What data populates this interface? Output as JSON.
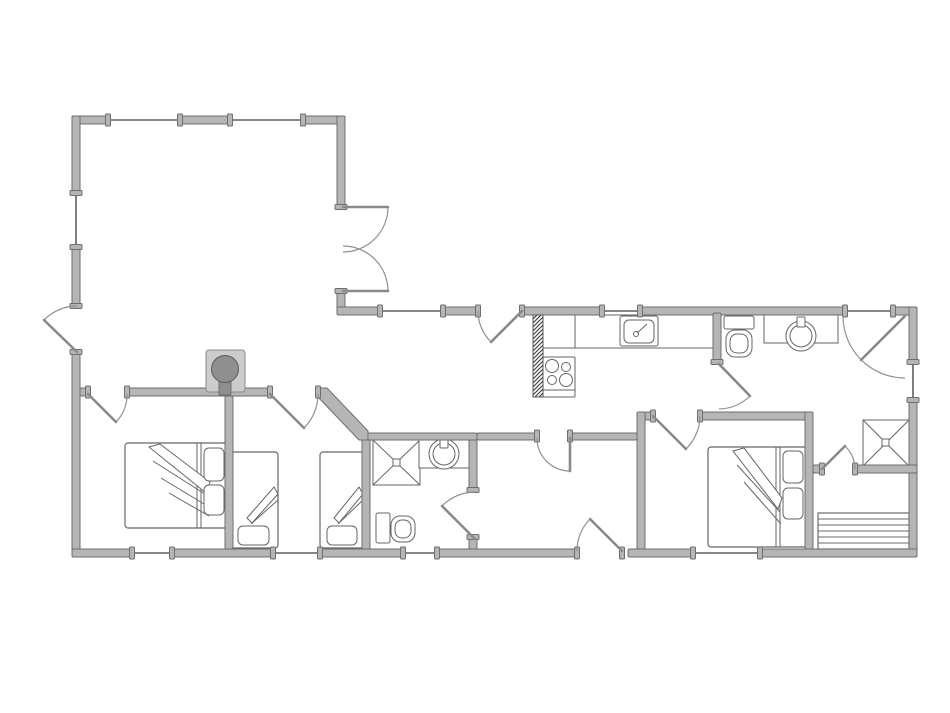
{
  "meta": {
    "type": "floor-plan",
    "description": "grayscale-cad-house-floor-plan"
  },
  "palette": {
    "background": "#ffffff",
    "wall_fill": "#b5b5b5",
    "wall_edge": "#6e6e6e",
    "window_line": "#5f5f5f",
    "fixture_line": "#666666",
    "fixture_fill": "#ffffff",
    "door_arc": "#909090",
    "door_leaf": "#8a8a8a",
    "stove_fill": "#8f8f8f",
    "stove_pad_fill": "#cccccc",
    "hatch_line": "#3a3a3a",
    "steps_line": "#6a6a6a"
  },
  "plan": {
    "canvas": {
      "w": 950,
      "h": 713
    },
    "walls": [
      {
        "name": "wall-north-a",
        "x": 72,
        "y": 116,
        "w": 36,
        "h": 8
      },
      {
        "name": "wall-north-b",
        "x": 180,
        "y": 116,
        "w": 50,
        "h": 8
      },
      {
        "name": "wall-north-c",
        "x": 303,
        "y": 116,
        "w": 42,
        "h": 8
      },
      {
        "name": "wall-west-a",
        "x": 72,
        "y": 116,
        "w": 8,
        "h": 77
      },
      {
        "name": "wall-west-b",
        "x": 72,
        "y": 247,
        "w": 8,
        "h": 59
      },
      {
        "name": "wall-west-c",
        "x": 72,
        "y": 352,
        "w": 8,
        "h": 205
      },
      {
        "name": "wall-living-east-a",
        "x": 337,
        "y": 116,
        "w": 8,
        "h": 91
      },
      {
        "name": "wall-living-east-b",
        "x": 337,
        "y": 291,
        "w": 8,
        "h": 20
      },
      {
        "name": "wall-wing-north-a",
        "x": 337,
        "y": 307,
        "w": 43,
        "h": 8
      },
      {
        "name": "wall-wing-north-b",
        "x": 443,
        "y": 307,
        "w": 35,
        "h": 8
      },
      {
        "name": "wall-wing-north-c",
        "x": 522,
        "y": 307,
        "w": 80,
        "h": 8
      },
      {
        "name": "wall-wing-north-d",
        "x": 640,
        "y": 307,
        "w": 205,
        "h": 8
      },
      {
        "name": "wall-wing-north-e",
        "x": 893,
        "y": 307,
        "w": 24,
        "h": 8
      },
      {
        "name": "wall-east-a",
        "x": 909,
        "y": 307,
        "w": 8,
        "h": 55
      },
      {
        "name": "wall-east-b",
        "x": 909,
        "y": 400,
        "w": 8,
        "h": 157
      },
      {
        "name": "wall-south-a",
        "x": 72,
        "y": 549,
        "w": 60,
        "h": 8
      },
      {
        "name": "wall-south-b",
        "x": 172,
        "y": 549,
        "w": 101,
        "h": 8
      },
      {
        "name": "wall-south-c",
        "x": 320,
        "y": 549,
        "w": 83,
        "h": 8
      },
      {
        "name": "wall-south-d",
        "x": 437,
        "y": 549,
        "w": 140,
        "h": 8
      },
      {
        "name": "wall-south-e",
        "x": 628,
        "y": 549,
        "w": 65,
        "h": 8
      },
      {
        "name": "wall-south-f",
        "x": 760,
        "y": 549,
        "w": 157,
        "h": 8
      },
      {
        "name": "wall-interior-stub-west",
        "x": 80,
        "y": 388,
        "w": 8,
        "h": 8
      },
      {
        "name": "wall-interior-bedrooms",
        "x": 127,
        "y": 388,
        "w": 143,
        "h": 8
      },
      {
        "name": "wall-bedroom-divider",
        "x": 225,
        "y": 396,
        "w": 8,
        "h": 153
      },
      {
        "name": "wall-bathroom-mid-west",
        "x": 362,
        "y": 433,
        "w": 8,
        "h": 116
      },
      {
        "name": "wall-bathroom-mid-north",
        "x": 362,
        "y": 433,
        "w": 115,
        "h": 7
      },
      {
        "name": "wall-bathroom-mid-east-a",
        "x": 469,
        "y": 440,
        "w": 8,
        "h": 50
      },
      {
        "name": "wall-bathroom-mid-east-b",
        "x": 469,
        "y": 537,
        "w": 8,
        "h": 12
      },
      {
        "name": "wall-hall-north-a",
        "x": 477,
        "y": 433,
        "w": 60,
        "h": 7
      },
      {
        "name": "wall-hall-north-b",
        "x": 570,
        "y": 433,
        "w": 67,
        "h": 7
      },
      {
        "name": "wall-bedroom3-west",
        "x": 637,
        "y": 412,
        "w": 8,
        "h": 137
      },
      {
        "name": "wall-bedroom3-north-stub",
        "x": 645,
        "y": 412,
        "w": 8,
        "h": 8
      },
      {
        "name": "wall-bedroom3-north",
        "x": 700,
        "y": 412,
        "w": 113,
        "h": 8
      },
      {
        "name": "wall-bathroom-north-west",
        "x": 713,
        "y": 313,
        "w": 8,
        "h": 49
      },
      {
        "name": "wall-bedroom3-east",
        "x": 805,
        "y": 412,
        "w": 8,
        "h": 137
      },
      {
        "name": "wall-shower-room-south-a",
        "x": 813,
        "y": 465,
        "w": 9,
        "h": 8
      },
      {
        "name": "wall-shower-room-south-b",
        "x": 855,
        "y": 465,
        "w": 62,
        "h": 8
      }
    ],
    "diagonal_walls": [
      {
        "name": "wall-diagonal-hall",
        "points": "318,388 327,388 368,431 368,440 359,440 318,397"
      }
    ],
    "windows": [
      {
        "name": "window-living-north-1",
        "x1": 108,
        "y1": 120,
        "x2": 180,
        "y2": 120,
        "o": "h"
      },
      {
        "name": "window-living-north-2",
        "x1": 230,
        "y1": 120,
        "x2": 303,
        "y2": 120,
        "o": "h"
      },
      {
        "name": "window-living-west",
        "x1": 76,
        "y1": 193,
        "x2": 76,
        "y2": 247,
        "o": "v"
      },
      {
        "name": "window-dining-north",
        "x1": 380,
        "y1": 311,
        "x2": 443,
        "y2": 311,
        "o": "h"
      },
      {
        "name": "window-kitchen-north",
        "x1": 602,
        "y1": 311,
        "x2": 640,
        "y2": 311,
        "o": "h"
      },
      {
        "name": "threshold-entry-northeast",
        "x1": 845,
        "y1": 311,
        "x2": 893,
        "y2": 311,
        "o": "h"
      },
      {
        "name": "window-east",
        "x1": 913,
        "y1": 362,
        "x2": 913,
        "y2": 400,
        "o": "v"
      },
      {
        "name": "window-bedroom1-south",
        "x1": 132,
        "y1": 553,
        "x2": 172,
        "y2": 553,
        "o": "h"
      },
      {
        "name": "window-bedroom2-south",
        "x1": 273,
        "y1": 553,
        "x2": 320,
        "y2": 553,
        "o": "h"
      },
      {
        "name": "window-bathroom-south",
        "x1": 403,
        "y1": 553,
        "x2": 437,
        "y2": 553,
        "o": "h"
      },
      {
        "name": "window-bedroom3-south",
        "x1": 693,
        "y1": 553,
        "x2": 760,
        "y2": 553,
        "o": "h"
      }
    ],
    "doors": [
      {
        "name": "door-entrance-west",
        "leaf": [
          77,
          352,
          44,
          320
        ],
        "arc": "M 77 306 A 46 46 0 0 0 44 320",
        "posts": [
          [
            76,
            306,
            "v"
          ],
          [
            76,
            352,
            "v"
          ]
        ]
      },
      {
        "name": "door-french-upper",
        "leaf": [
          343,
          207,
          388,
          207
        ],
        "arc": "M 388 207 A 45 45 0 0 1 343 252",
        "posts": [
          [
            341,
            207,
            "v"
          ],
          [
            341,
            291,
            "v"
          ]
        ]
      },
      {
        "name": "door-french-lower",
        "leaf": [
          343,
          291,
          388,
          291
        ],
        "arc": "M 388 291 A 45 45 0 0 0 343 246",
        "posts": []
      },
      {
        "name": "door-terrace-dining",
        "leaf": [
          522,
          311,
          491,
          342
        ],
        "arc": "M 478 311 A 44 44 0 0 0 491 342",
        "posts": [
          [
            478,
            311,
            "h"
          ],
          [
            522,
            311,
            "h"
          ]
        ]
      },
      {
        "name": "door-entrance-northeast",
        "leaf": [
          905,
          316,
          861,
          360
        ],
        "arc": "M 843 316 A 62 62 0 0 0 905 378",
        "posts": []
      },
      {
        "name": "door-bedroom1",
        "leaf": [
          88,
          394,
          116,
          422
        ],
        "arc": "M 127 394 A 39 39 0 0 1 116 422",
        "posts": [
          [
            88,
            392,
            "h"
          ],
          [
            127,
            392,
            "h"
          ]
        ]
      },
      {
        "name": "door-bedroom2",
        "leaf": [
          270,
          394,
          304,
          428
        ],
        "arc": "M 318 394 A 48 48 0 0 1 304 428",
        "posts": [
          [
            270,
            392,
            "h"
          ],
          [
            318,
            392,
            "h"
          ]
        ]
      },
      {
        "name": "door-dining-hall",
        "leaf": [
          570,
          438,
          570,
          471
        ],
        "arc": "M 537 438 A 33 33 0 0 0 570 471",
        "posts": [
          [
            537,
            436,
            "h"
          ],
          [
            570,
            436,
            "h"
          ]
        ]
      },
      {
        "name": "door-hall-bedroom3",
        "leaf": [
          653,
          416,
          686,
          449
        ],
        "arc": "M 700 416 A 47 47 0 0 1 686 449",
        "posts": [
          [
            653,
            416,
            "h"
          ],
          [
            700,
            416,
            "h"
          ]
        ]
      },
      {
        "name": "door-bathroom-north",
        "leaf": [
          719,
          364,
          750,
          396
        ],
        "arc": "M 719 409 A 45 45 0 0 0 750 396",
        "posts": [
          [
            717,
            362,
            "v"
          ]
        ]
      },
      {
        "name": "door-bathroom-mid",
        "leaf": [
          475,
          539,
          442,
          506
        ],
        "arc": "M 475 492 A 47 47 0 0 0 442 506",
        "posts": [
          [
            473,
            490,
            "v"
          ],
          [
            473,
            537,
            "v"
          ]
        ]
      },
      {
        "name": "door-entrance-south",
        "leaf": [
          622,
          551,
          590,
          519
        ],
        "arc": "M 577 551 A 45 45 0 0 1 590 519",
        "posts": [
          [
            577,
            553,
            "h"
          ],
          [
            622,
            553,
            "h"
          ]
        ]
      },
      {
        "name": "door-shower-room",
        "leaf": [
          822,
          469,
          845,
          446
        ],
        "arc": "M 855 469 A 33 33 0 0 0 845 446",
        "posts": [
          [
            822,
            469,
            "h"
          ],
          [
            855,
            469,
            "h"
          ]
        ]
      }
    ],
    "chimney": {
      "name": "chimney-flue",
      "x": 533,
      "y": 315,
      "w": 10,
      "h": 82
    },
    "kitchen": {
      "counter": {
        "x": 541,
        "y": 315,
        "w": 172,
        "h": 33
      },
      "divider": [
        575,
        315,
        575,
        348
      ],
      "sink": {
        "outer": [
          620,
          316,
          38,
          30
        ],
        "inner": [
          624,
          320,
          30,
          23
        ],
        "tap": [
          636,
          334
        ],
        "lever": [
          637,
          333,
          647,
          324
        ]
      },
      "range": {
        "outer": [
          543,
          357,
          32,
          40
        ],
        "drawer_line": [
          543,
          390,
          575,
          390
        ],
        "burners": [
          [
            552,
            366,
            6.5
          ],
          [
            566,
            367,
            4.5
          ],
          [
            552,
            380,
            4.5
          ],
          [
            566,
            380,
            6.5
          ]
        ]
      }
    },
    "stove": {
      "pad": [
        206,
        350,
        39,
        42
      ],
      "circle": [
        225,
        369,
        13.5
      ],
      "flue": [
        219,
        377,
        12,
        18
      ]
    },
    "bathroom_north": {
      "toilet": {
        "tank": [
          724,
          316,
          30,
          13
        ],
        "bowl": [
          726,
          330,
          26,
          27
        ],
        "bowl_inner": [
          730,
          334,
          18,
          19
        ]
      },
      "vanity": {
        "counter": [
          764,
          315,
          74,
          28
        ],
        "basin": [
          801,
          336,
          15,
          11
        ],
        "tap": [
          797,
          317,
          8,
          10
        ]
      }
    },
    "bathroom_mid": {
      "shower": {
        "box": [
          373,
          440,
          47,
          45
        ],
        "drain": [
          393,
          459,
          7,
          7
        ]
      },
      "vanity": {
        "counter": [
          419,
          437,
          51,
          31
        ],
        "basin": [
          444,
          454,
          15,
          11
        ],
        "tap": [
          440,
          438,
          8,
          10
        ]
      },
      "toilet": {
        "tank": [
          376,
          513,
          14,
          30
        ],
        "bowl": [
          391,
          516,
          24,
          26
        ],
        "bowl_inner": [
          395,
          520,
          16,
          18
        ]
      }
    },
    "shower_room": {
      "shower": {
        "box": [
          863,
          420,
          46,
          46
        ],
        "drain": [
          882,
          439,
          7,
          7
        ]
      }
    },
    "steps": {
      "box": [
        818,
        513,
        91,
        36
      ],
      "treads_y": [
        519,
        525,
        531,
        537,
        543
      ]
    },
    "beds": [
      {
        "name": "bed-double-west",
        "frame": [
          125,
          443,
          103,
          85
        ],
        "lines": [
          [
            197,
            443,
            197,
            528
          ],
          [
            201,
            443,
            201,
            528
          ]
        ],
        "pillows": [
          [
            204,
            448,
            20,
            33
          ],
          [
            204,
            485,
            20,
            30
          ]
        ],
        "wedge": "149,447 160,444 210,482 206,493",
        "wedge_lines": [
          [
            153,
            461,
            208,
            496
          ],
          [
            161,
            478,
            209,
            507
          ],
          [
            169,
            493,
            209,
            516
          ]
        ]
      },
      {
        "name": "bed-single-left",
        "frame": [
          230,
          452,
          48,
          96
        ],
        "lines": [],
        "pillows": [
          [
            238,
            526,
            31,
            19
          ]
        ],
        "wedge": "247,518 274,487 278,494 252,523",
        "wedge_lines": [
          [
            251,
            524,
            278,
            500
          ]
        ]
      },
      {
        "name": "bed-single-right",
        "frame": [
          320,
          452,
          44,
          96
        ],
        "lines": [],
        "pillows": [
          [
            327,
            526,
            30,
            19
          ]
        ],
        "wedge": "334,518 359,487 363,494 339,523",
        "wedge_lines": [
          [
            338,
            524,
            363,
            500
          ]
        ]
      },
      {
        "name": "bed-double-east",
        "frame": [
          708,
          447,
          99,
          100
        ],
        "lines": [
          [
            776,
            447,
            776,
            547
          ],
          [
            780,
            447,
            780,
            547
          ]
        ],
        "pillows": [
          [
            783,
            451,
            20,
            32
          ],
          [
            783,
            488,
            20,
            31
          ]
        ],
        "wedge": "733,451 744,448 782,498 778,509",
        "wedge_lines": [
          [
            737,
            465,
            780,
            512
          ],
          [
            744,
            482,
            781,
            524
          ]
        ]
      }
    ]
  }
}
